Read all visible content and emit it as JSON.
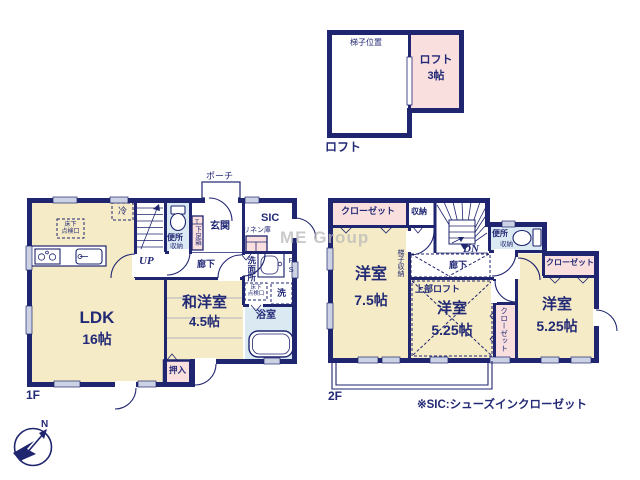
{
  "colors": {
    "wall": "#1f256f",
    "beige": "#f5ebc6",
    "pink": "#fadfdf",
    "blue": "#dbe9f3",
    "window": "#ccd2e4",
    "text": "#232a75",
    "watermark": "#b9b9b9"
  },
  "loft": {
    "ladder_position": "梯子位置",
    "room_name": "ロフト",
    "room_size": "3帖",
    "floor_label": "ロフト"
  },
  "f1": {
    "floor_label": "1F",
    "ldk_name": "LDK",
    "ldk_size": "16帖",
    "washitsu_name": "和洋室",
    "washitsu_size": "4.5帖",
    "oshiire": "押入",
    "porch": "ポーチ",
    "genkan": "玄関",
    "sic": "SIC",
    "linen": "リネン庫",
    "shoebox": "T下足箱",
    "toilet": "便所",
    "toilet_storage": "収納",
    "hall": "廊下",
    "up": "UP",
    "washroom": "洗面所",
    "ps": "PS",
    "washer": "洗",
    "bath": "浴室",
    "fridge": "冷",
    "underfloor_line1": "床下",
    "underfloor_line2": "点検口"
  },
  "f2": {
    "floor_label": "2F",
    "closet": "クローゼット",
    "storage": "収納",
    "dn": "DN",
    "hall": "廊下",
    "ladder_storage": "梯子収納",
    "toilet": "便所",
    "toilet_storage": "収納",
    "upper_loft": "上部ロフト",
    "room_a_name": "洋室",
    "room_a_size": "7.5帖",
    "room_b_name": "洋室",
    "room_b_size": "5.25帖",
    "room_c_name": "洋室",
    "room_c_size": "5.25帖"
  },
  "misc": {
    "note": "※SIC:シューズインクローゼット",
    "watermark": "ME Group",
    "compass_north": "N"
  }
}
